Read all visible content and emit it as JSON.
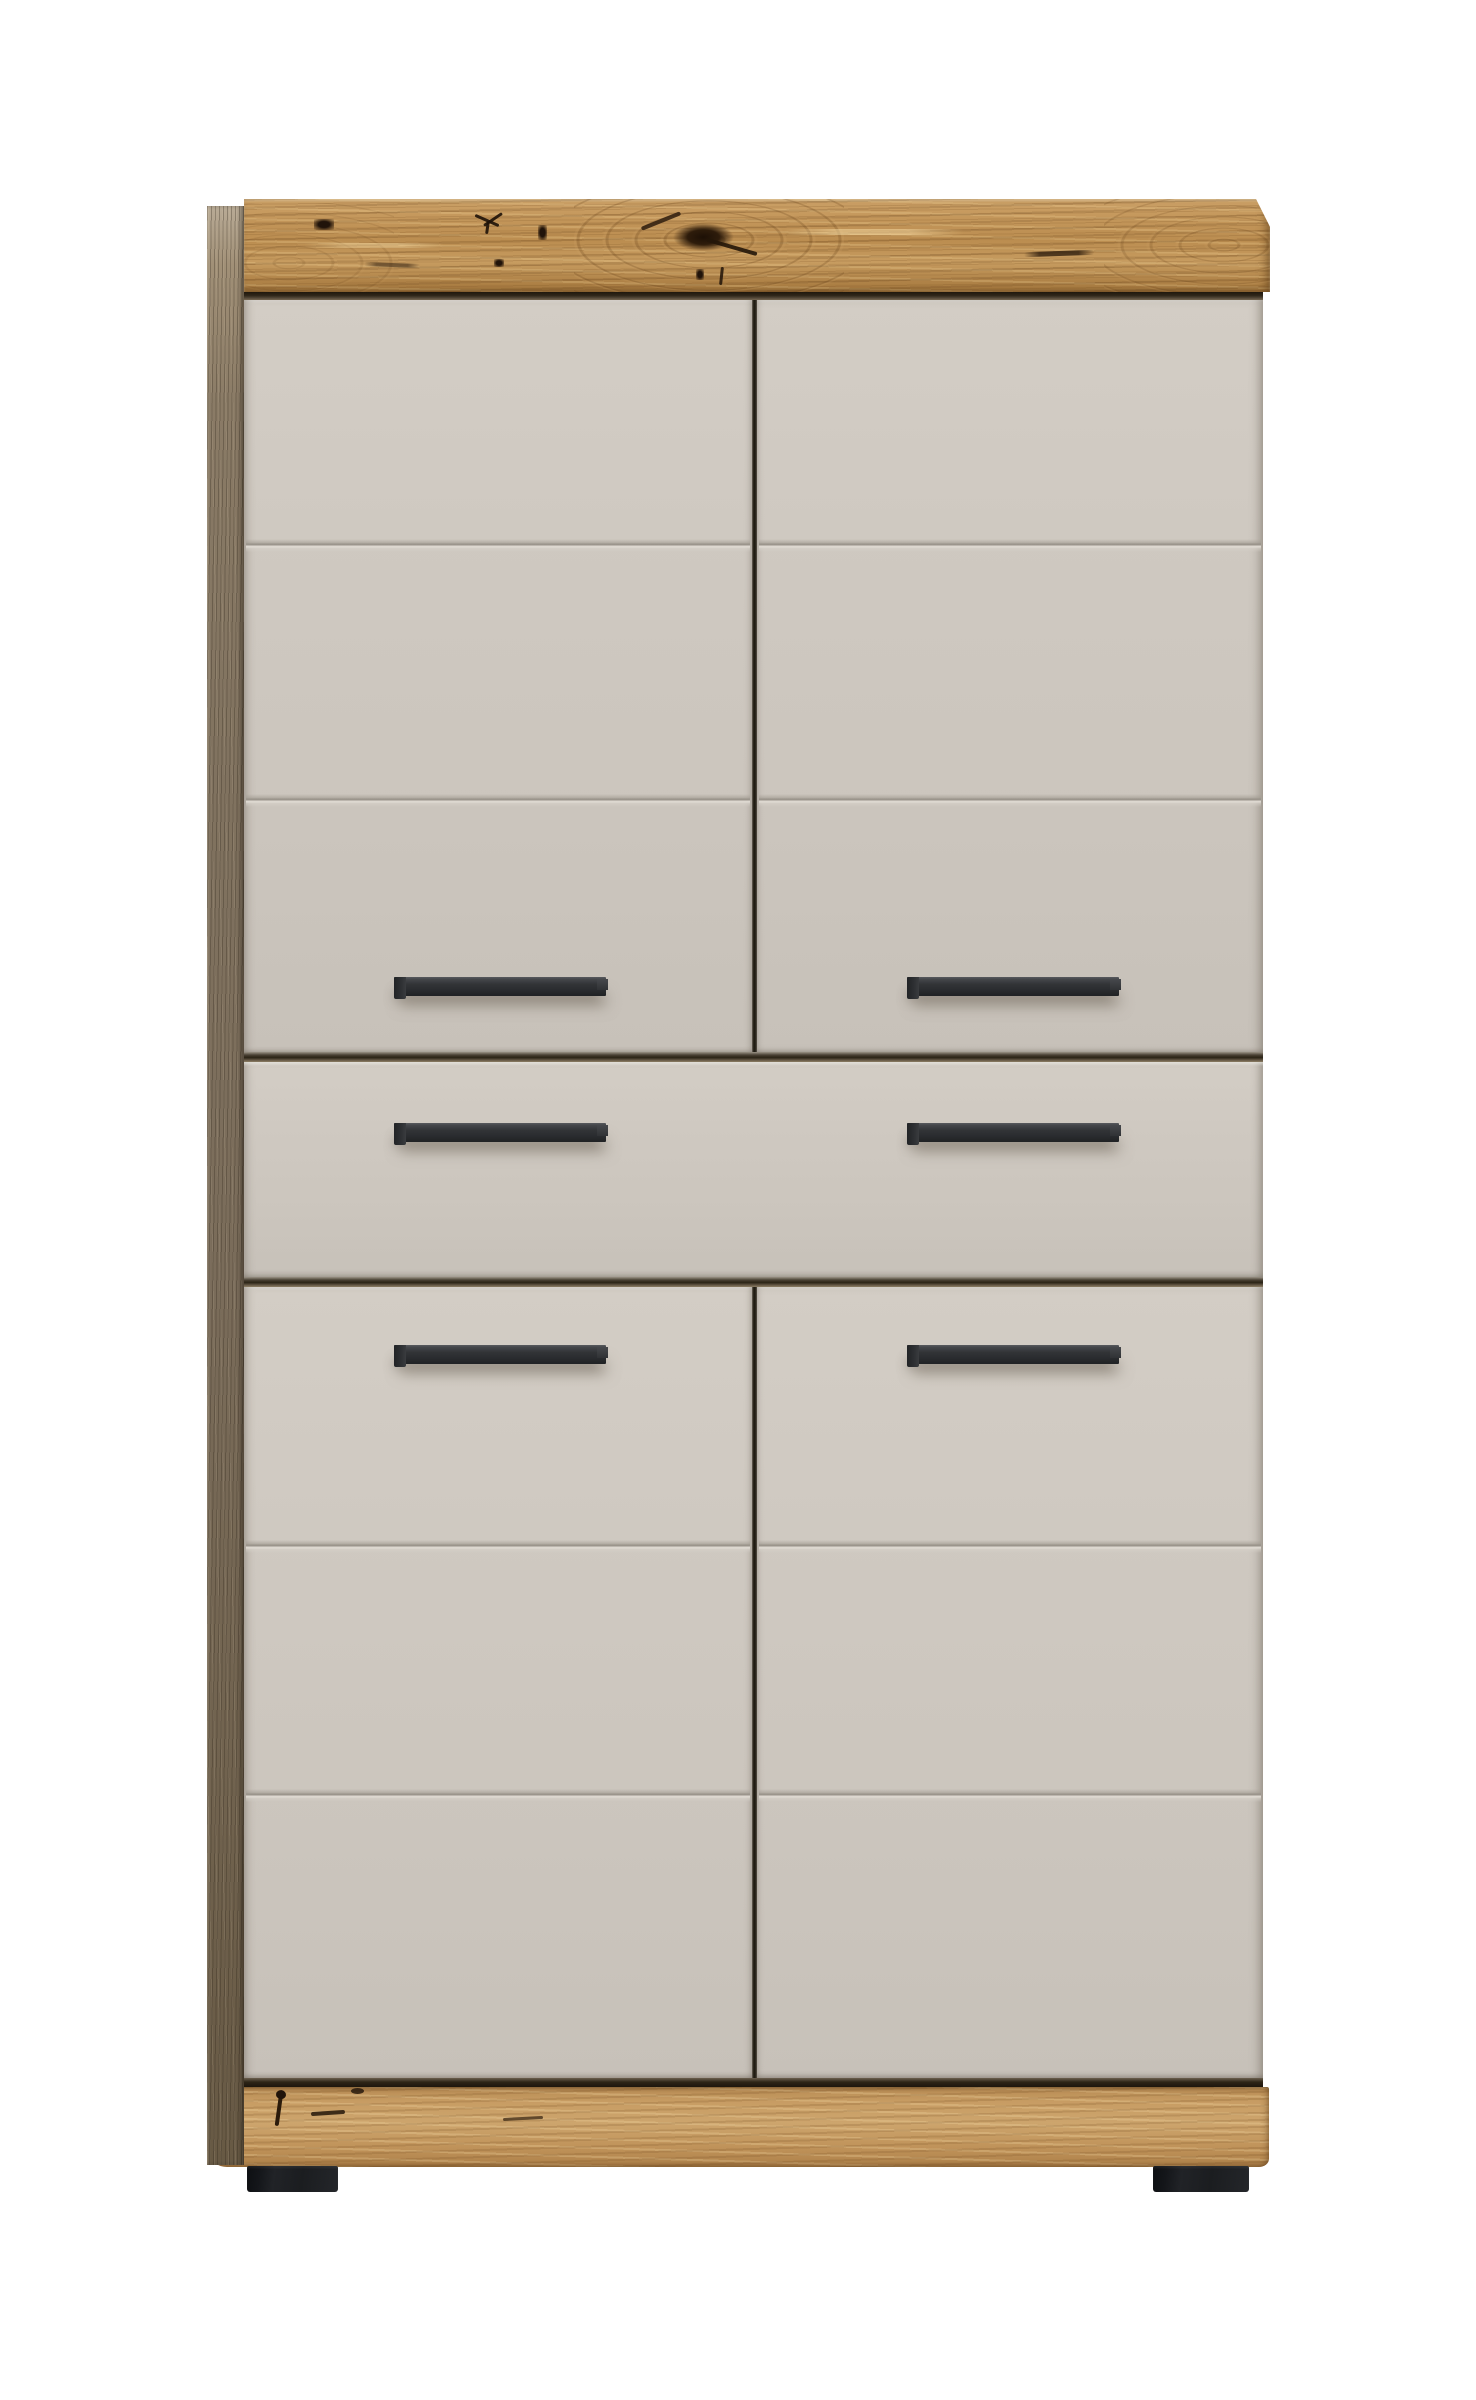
{
  "image": {
    "type": "product-photo",
    "subject": "Tall storage cabinet with knotty oak top trim and plinth, matte taupe door and drawer fronts, black bar handles and black feet, on a plain white background",
    "background_color": "#ffffff"
  },
  "cabinet": {
    "structure": {
      "upper_doors": 2,
      "center_drawers": 1,
      "lower_doors": 2,
      "grooves_per_door": 2,
      "handles_total": 6,
      "feet_total": 2,
      "handle_layout": "one horizontal bar handle centered on each door half and each drawer half; rows on upper doors, drawer and lower doors"
    },
    "materials": {
      "top_trim": "knotty natural oak with dark knots and grain swirls",
      "plinth": "natural oak with small knots and cracks",
      "side_panel": "dark grey-brown wood edge",
      "fronts": "matte taupe grey laminate"
    },
    "colors": {
      "background": "#ffffff",
      "front": "#cfc9c1",
      "front_dark": "#c7c1b9",
      "front_highlight": "#dcd7cf",
      "wood_light": "#cda268",
      "wood_mid": "#bb8d50",
      "wood_dark": "#a67a40",
      "plinth": "#cda56d",
      "side_panel": "#7a6c5a",
      "gap": "#1c1810",
      "handle": "#323437",
      "feet": "#1b1d20",
      "knot": "#2e1c0b"
    }
  }
}
